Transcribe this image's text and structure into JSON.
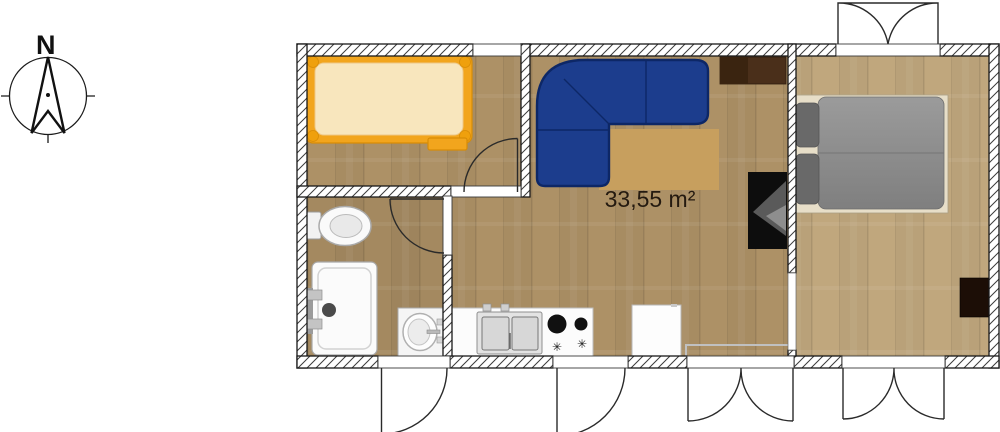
{
  "plan": {
    "area_label": "33,55 m²",
    "rooms": [
      {
        "name": "small-bedroom",
        "furniture": [
          "single-bed-orange"
        ]
      },
      {
        "name": "bathroom",
        "furniture": [
          "toilet",
          "shower",
          "washbasin"
        ]
      },
      {
        "name": "living-kitchen",
        "furniture": [
          "corner-sofa",
          "coffee-table",
          "sideboard",
          "tv",
          "kitchen-sink",
          "stove",
          "fridge"
        ]
      },
      {
        "name": "main-bedroom",
        "furniture": [
          "double-bed",
          "chest"
        ]
      }
    ],
    "doors": [
      "small-bedroom-door",
      "bathroom-door",
      "bathroom-exterior-door",
      "kitchen-exterior-door",
      "living-french-doors",
      "bedroom-french-doors",
      "bedroom-top-double-door",
      "living-bedroom-opening"
    ],
    "windows": [
      "small-bedroom-window"
    ]
  },
  "compass": {
    "north_label": "N"
  },
  "icons": {
    "burner_symbol": "✳"
  },
  "colors": {
    "floor_wood": "#ad9166",
    "floor_wood_bedroom": "#c0a77d",
    "sofa_blue": "#1c3d8d",
    "bed_frame_orange": "#f2a51d",
    "mattress_cream": "#f8e6bd",
    "table_tan": "#c79f5e",
    "sideboard_brown": "#4a2f1a",
    "tv_black": "#0d0d0d",
    "chest_dark_brown": "#1c0e06",
    "duvet_gray": "#8d8d8d",
    "pillow_gray": "#696969",
    "label_text": "#241a10"
  }
}
